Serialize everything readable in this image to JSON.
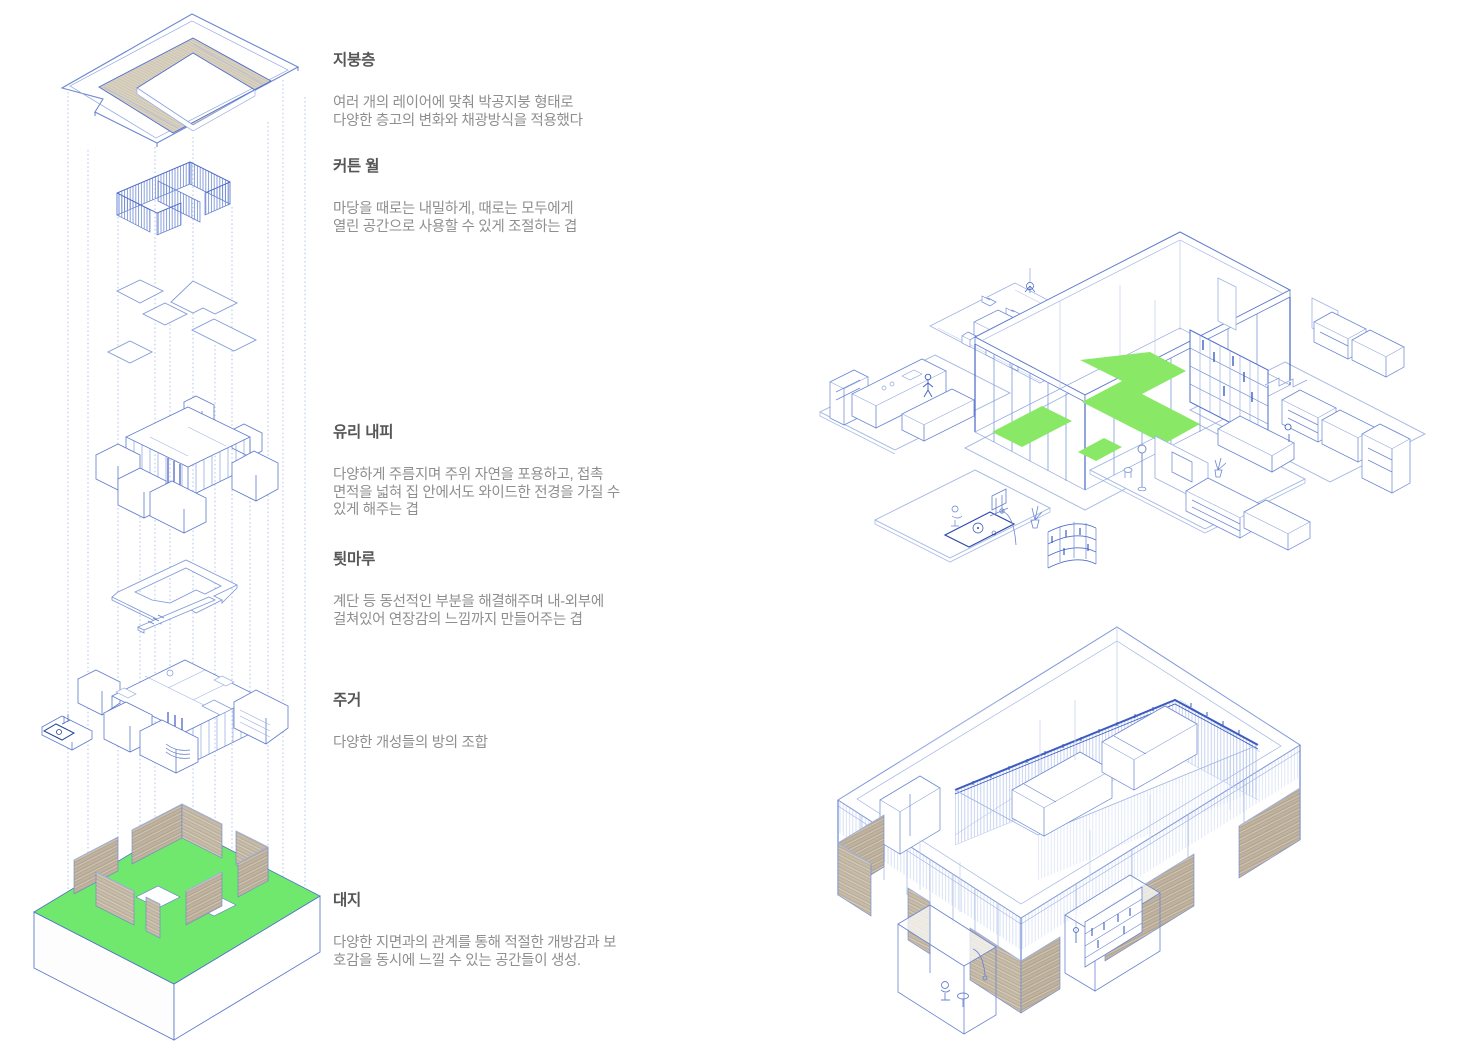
{
  "page": {
    "background": "#ffffff",
    "width": 1462,
    "height": 1045
  },
  "palette": {
    "line_blue": "#4f6ecb",
    "line_blue_dark": "#2e4cb8",
    "line_blue_light": "#9fb4e3",
    "guide_dotted_blue": "#9db2e4",
    "site_green": "#6fe86d",
    "floor_highlight_green": "#8ae867",
    "wood_tan": "#c6bba8",
    "roof_wood": "#d9d2c2",
    "heading_text": "#575757",
    "body_text": "#8f8f8f"
  },
  "legend": {
    "sections": [
      {
        "title": "지붕층",
        "body": [
          "여러 개의 레이어에 맞춰 박공지붕 형태로",
          "다양한 층고의 변화와 채광방식을 적용했다"
        ]
      },
      {
        "title": "커튼 월",
        "body": [
          "마당을 때로는 내밀하게, 때로는 모두에게",
          "열린 공간으로 사용할 수 있게 조절하는 겹"
        ]
      },
      {
        "title": "유리 내피",
        "body": [
          "다양하게 주름지며 주위 자연을 포용하고, 접촉",
          "면적을 넓혀 집 안에서도 와이드한 전경을 가질 수",
          "있게 해주는 겹"
        ]
      },
      {
        "title": "툇마루",
        "body": [
          "계단 등 동선적인 부분을 해결해주며 내-외부에",
          "걸쳐있어 연장감의 느낌까지 만들어주는 겹"
        ]
      },
      {
        "title": "주거",
        "body": [
          "다양한 개성들의 방의 조합"
        ]
      },
      {
        "title": "대지",
        "body": [
          "다양한 지면과의 관계를 통해  적절한 개방감과 보",
          "호감을 동시에 느낄 수 있는 공간들이 생성."
        ]
      }
    ]
  }
}
